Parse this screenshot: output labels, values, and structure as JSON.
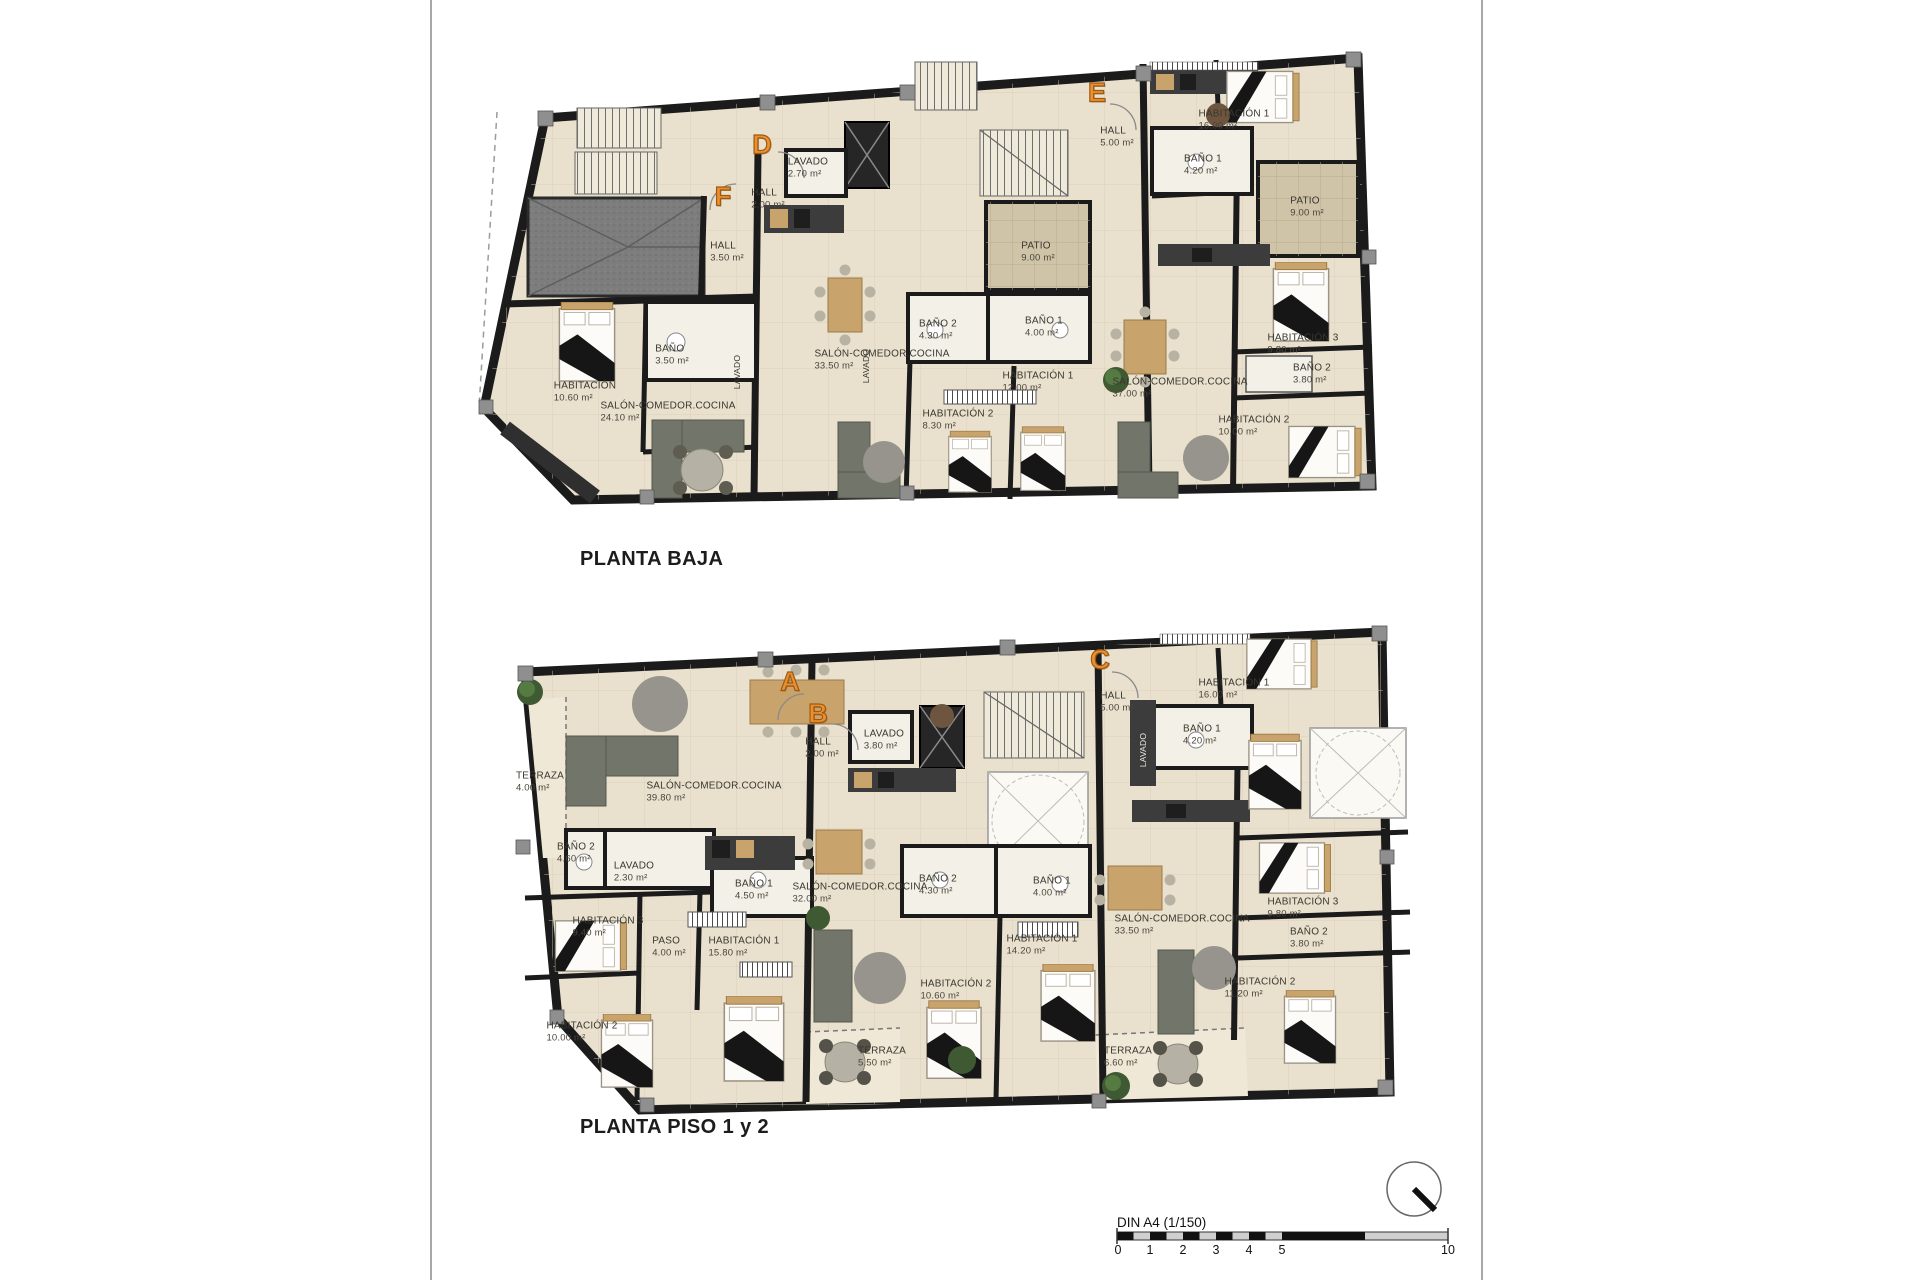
{
  "sheet": {
    "titles": {
      "upper": "PLANTA BAJA",
      "lower": "PLANTA PISO 1 y 2"
    },
    "scale_bar": {
      "title": "DIN A4 (1/150)",
      "ticks": [
        {
          "label": "0",
          "x": 1118
        },
        {
          "label": "1",
          "x": 1150
        },
        {
          "label": "2",
          "x": 1183
        },
        {
          "label": "3",
          "x": 1216
        },
        {
          "label": "4",
          "x": 1249
        },
        {
          "label": "5",
          "x": 1282
        },
        {
          "label": "10",
          "x": 1448
        }
      ]
    },
    "colors": {
      "accent_letter": "#ee8f2d",
      "wall": "#1b1b1b",
      "floor": "#e9e1ce",
      "roof": "#7d7d7d",
      "patio": "#cfc4a8"
    }
  },
  "plans": [
    {
      "id": "planta-baja",
      "title": "PLANTA BAJA",
      "units": [
        {
          "letter": "F",
          "pos": {
            "x": 723,
            "y": 197
          },
          "rooms": [
            {
              "name": "HALL",
              "area": "3.50 m²",
              "x": 727,
              "y": 252
            },
            {
              "name": "BAÑO",
              "area": "3.50 m²",
              "x": 672,
              "y": 355
            },
            {
              "name": "LAVADO",
              "area": "",
              "x": 737,
              "y": 372,
              "vert": true
            },
            {
              "name": "HABITACIÓN",
              "area": "10.60 m²",
              "x": 585,
              "y": 392
            },
            {
              "name": "SALÓN-COMEDOR.COCINA",
              "area": "24.10 m²",
              "x": 668,
              "y": 412
            }
          ]
        },
        {
          "letter": "D",
          "pos": {
            "x": 762,
            "y": 145
          },
          "rooms": [
            {
              "name": "LAVADO",
              "area": "2.70 m²",
              "x": 808,
              "y": 168
            },
            {
              "name": "HALL",
              "area": "2.00 m²",
              "x": 768,
              "y": 199
            },
            {
              "name": "PATIO",
              "area": "9.00 m²",
              "x": 1038,
              "y": 252
            },
            {
              "name": "LAVADO",
              "area": "",
              "x": 866,
              "y": 366,
              "vert": true
            },
            {
              "name": "SALÓN-COMEDOR.COCINA",
              "area": "33.50 m²",
              "x": 882,
              "y": 360
            },
            {
              "name": "BAÑO 2",
              "area": "4.30 m²",
              "x": 938,
              "y": 330
            },
            {
              "name": "BAÑO 1",
              "area": "4.00 m²",
              "x": 1044,
              "y": 327
            },
            {
              "name": "HABITACIÓN 1",
              "area": "12.00 m²",
              "x": 1038,
              "y": 382
            },
            {
              "name": "HABITACIÓN 2",
              "area": "8.30 m²",
              "x": 958,
              "y": 420
            }
          ]
        },
        {
          "letter": "E",
          "pos": {
            "x": 1097,
            "y": 93
          },
          "rooms": [
            {
              "name": "HALL",
              "area": "5.00 m²",
              "x": 1117,
              "y": 137
            },
            {
              "name": "HABITACIÓN 1",
              "area": "16.00 m²",
              "x": 1234,
              "y": 120
            },
            {
              "name": "BAÑO 1",
              "area": "4.20 m²",
              "x": 1203,
              "y": 165
            },
            {
              "name": "PATIO",
              "area": "9.00 m²",
              "x": 1307,
              "y": 207
            },
            {
              "name": "SALÓN-COMEDOR.COCINA",
              "area": "37.00 m²",
              "x": 1180,
              "y": 388
            },
            {
              "name": "HABITACIÓN 3",
              "area": "9.80 m²",
              "x": 1303,
              "y": 344
            },
            {
              "name": "BAÑO 2",
              "area": "3.80 m²",
              "x": 1312,
              "y": 374
            },
            {
              "name": "HABITACIÓN 2",
              "area": "10.00 m²",
              "x": 1254,
              "y": 426
            }
          ]
        }
      ]
    },
    {
      "id": "planta-piso-1-y-2",
      "title": "PLANTA PISO 1 y 2",
      "units": [
        {
          "letter": "A",
          "pos": {
            "x": 790,
            "y": 682
          },
          "rooms": [
            {
              "name": "TERRAZA",
              "area": "4.00 m²",
              "x": 540,
              "y": 782
            },
            {
              "name": "SALÓN-COMEDOR.COCINA",
              "area": "39.80 m²",
              "x": 714,
              "y": 792
            },
            {
              "name": "BAÑO 2",
              "area": "4.60 m²",
              "x": 576,
              "y": 853
            },
            {
              "name": "LAVADO",
              "area": "2.30 m²",
              "x": 634,
              "y": 872
            },
            {
              "name": "HABITACIÓN 3",
              "area": "9.40 m²",
              "x": 608,
              "y": 927
            },
            {
              "name": "PASO",
              "area": "4.00 m²",
              "x": 669,
              "y": 947
            },
            {
              "name": "BAÑO 1",
              "area": "4.50 m²",
              "x": 754,
              "y": 890
            },
            {
              "name": "HABITACIÓN 1",
              "area": "15.80 m²",
              "x": 744,
              "y": 947
            },
            {
              "name": "HABITACIÓN 2",
              "area": "10.00 m²",
              "x": 582,
              "y": 1032
            }
          ]
        },
        {
          "letter": "B",
          "pos": {
            "x": 818,
            "y": 714
          },
          "rooms": [
            {
              "name": "HALL",
              "area": "2.00 m²",
              "x": 822,
              "y": 748
            },
            {
              "name": "LAVADO",
              "area": "3.80 m²",
              "x": 884,
              "y": 740
            },
            {
              "name": "SALÓN-COMEDOR.COCINA",
              "area": "32.00 m²",
              "x": 860,
              "y": 893
            },
            {
              "name": "BAÑO 2",
              "area": "4.30 m²",
              "x": 938,
              "y": 885
            },
            {
              "name": "BAÑO 1",
              "area": "4.00 m²",
              "x": 1052,
              "y": 887
            },
            {
              "name": "HABITACIÓN 1",
              "area": "14.20 m²",
              "x": 1042,
              "y": 945
            },
            {
              "name": "HABITACIÓN 2",
              "area": "10.60 m²",
              "x": 956,
              "y": 990
            },
            {
              "name": "TERRAZA",
              "area": "5.50 m²",
              "x": 882,
              "y": 1057
            }
          ]
        },
        {
          "letter": "C",
          "pos": {
            "x": 1100,
            "y": 660
          },
          "rooms": [
            {
              "name": "HALL",
              "area": "5.00 m²",
              "x": 1117,
              "y": 702
            },
            {
              "name": "HABITACIÓN 1",
              "area": "16.00 m²",
              "x": 1234,
              "y": 689
            },
            {
              "name": "BAÑO 1",
              "area": "4.20 m²",
              "x": 1202,
              "y": 735
            },
            {
              "name": "LAVADO",
              "area": "",
              "x": 1143,
              "y": 750,
              "vert": true,
              "light": true
            },
            {
              "name": "SALÓN-COMEDOR.COCINA",
              "area": "33.50 m²",
              "x": 1182,
              "y": 925
            },
            {
              "name": "HABITACIÓN 3",
              "area": "9.80 m²",
              "x": 1303,
              "y": 908
            },
            {
              "name": "BAÑO 2",
              "area": "3.80 m²",
              "x": 1309,
              "y": 938
            },
            {
              "name": "HABITACIÓN 2",
              "area": "11.20 m²",
              "x": 1260,
              "y": 988
            },
            {
              "name": "TERRAZA",
              "area": "6.60 m²",
              "x": 1128,
              "y": 1057
            }
          ]
        }
      ]
    }
  ]
}
